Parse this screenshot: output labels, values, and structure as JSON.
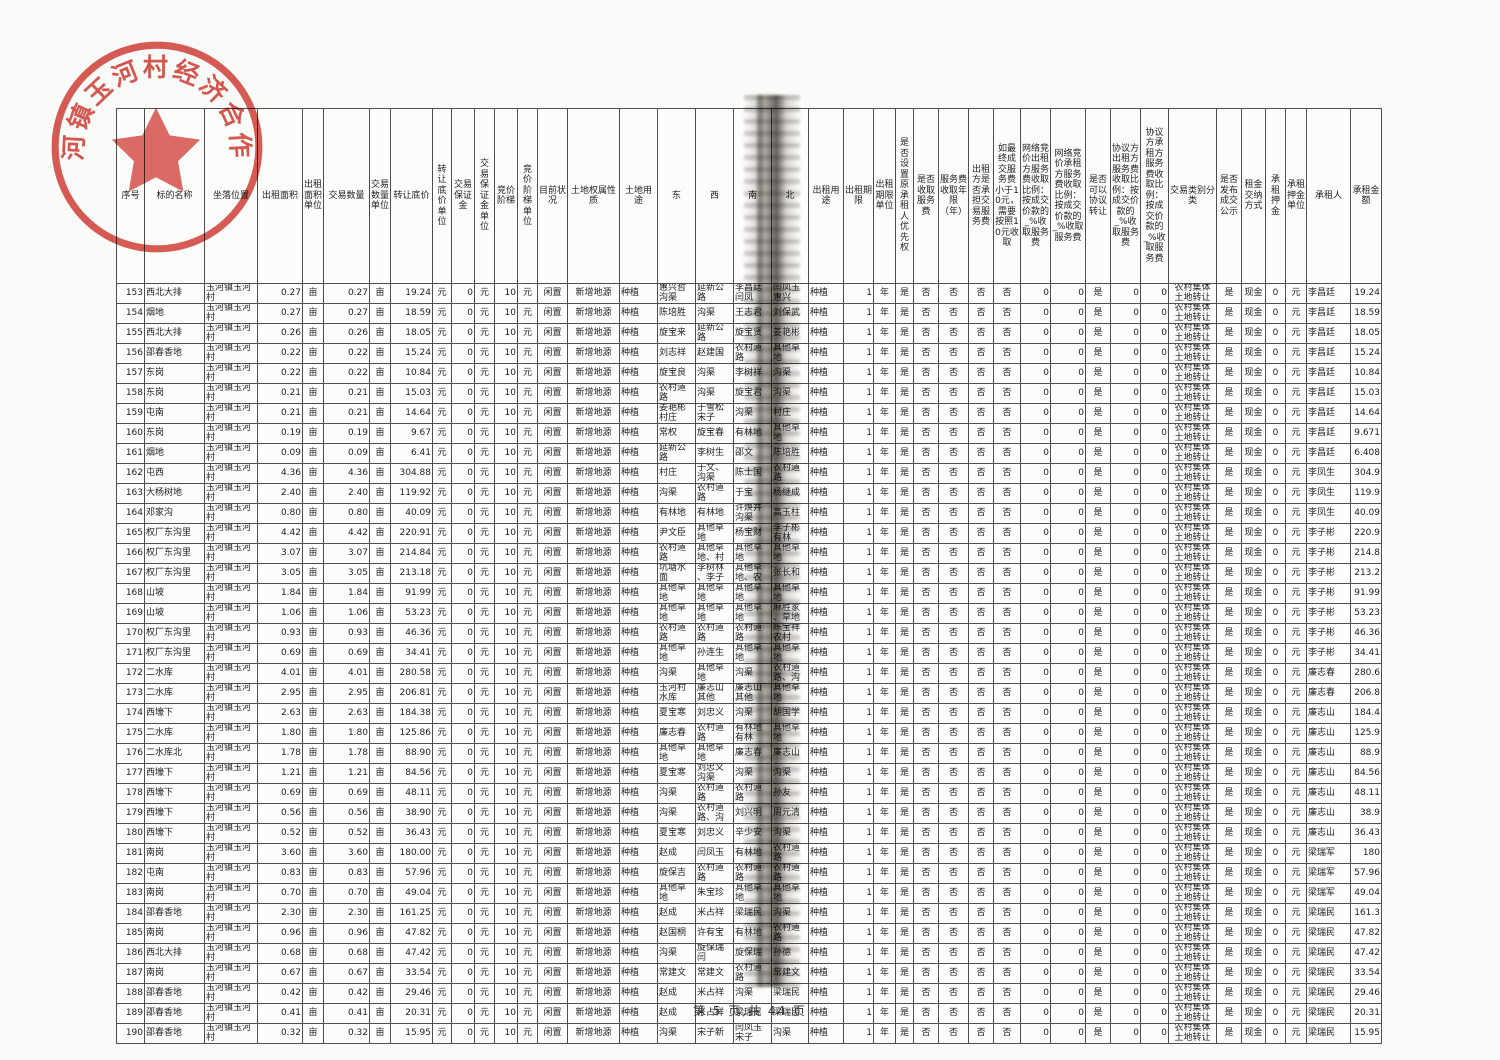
{
  "page": {
    "footer": "第 5 页,共 44 页"
  },
  "stamp": {
    "text": "玉河镇玉河村经济合作社",
    "color": "#cf3128"
  },
  "table": {
    "headers": [
      "序号",
      "标的名称",
      "坐落位置",
      "出租面积",
      "出租面积单位",
      "交易数量",
      "交易数量单位",
      "转让底价",
      "转让底价单位",
      "交易保证金",
      "交易保证金单位",
      "竞价阶梯",
      "竞价阶梯单位",
      "目前状况",
      "土地权属性质",
      "土地用途",
      "东",
      "西",
      "南",
      "北",
      "出租用途",
      "出租期限",
      "出租期限单位",
      "是否设置原承租人优先权",
      "是否收取服务费",
      "服务费收取年限（年）",
      "出租方是否承担交易服务费",
      "如最终成交服务费小于10元，需要按照10元收取",
      "网络竞价出租方服务费收取比例：按成交价款的_%收取服务费",
      "网络竞价承租方服务费收取比例：按成交价款的_%收取服务费",
      "是否可以协议转让",
      "协议方出租方服务费收取比例：按成交价款的_%收取服务费",
      "协议方承租方服务费收取比例：按成交价款的_%收取服务费",
      "交易类别分类",
      "是否发布成交公示",
      "租金交纳方式",
      "承租押金",
      "承租押金单位",
      "承租人",
      "承租金额"
    ],
    "constants": {
      "location": "玉河镇玉河村",
      "area_unit": "亩",
      "qty_unit": "亩",
      "price_unit": "元",
      "deposit": "0",
      "deposit_unit": "元",
      "step": "10",
      "step_unit": "元",
      "status": "闲置",
      "ownership": "新增地源",
      "land_use": "种植",
      "lease_use": "种植",
      "term": "1",
      "term_unit": "年",
      "priority": "是",
      "collect_service_fee": "否",
      "fee_years": "否",
      "lessor_bears_fee": "否",
      "min_fee_rule": "否",
      "net_lessor_pct": "0",
      "net_lessee_pct": "0",
      "negotiable_transfer": "是",
      "agr_lessor_pct": "0",
      "agr_lessee_pct": "0",
      "category": "农村集体\n土地转让",
      "publicity": "是",
      "payment": "现金",
      "rent_deposit": "0",
      "rent_deposit_unit": "元"
    },
    "rows": [
      {
        "no": "153",
        "name": "西北大排",
        "area": "0.27",
        "qty": "0.27",
        "price": "19.24",
        "east": "惠兴哲\n沟渠",
        "west": "延新公\n路",
        "south": "李昌廷\n闫凤",
        "north": "闫凤玉\n惠兴",
        "lessee": "李昌廷",
        "amount": "19.24"
      },
      {
        "no": "154",
        "name": "烟地",
        "area": "0.27",
        "qty": "0.27",
        "price": "18.59",
        "east": "陈培胜",
        "west": "沟渠",
        "south": "王志君",
        "north": "刘保武",
        "lessee": "李昌廷",
        "amount": "18.59"
      },
      {
        "no": "155",
        "name": "西北大排",
        "area": "0.26",
        "qty": "0.26",
        "price": "18.05",
        "east": "旋宝来",
        "west": "延新公\n路",
        "south": "旋宝贤",
        "north": "姜艳彬",
        "lessee": "李昌廷",
        "amount": "18.05"
      },
      {
        "no": "156",
        "name": "邵春香地",
        "area": "0.22",
        "qty": "0.22",
        "price": "15.24",
        "east": "刘志祥",
        "west": "赵建国",
        "south": "农村道\n路",
        "north": "其他草\n地",
        "lessee": "李昌廷",
        "amount": "15.24"
      },
      {
        "no": "157",
        "name": "东岗",
        "area": "0.22",
        "qty": "0.22",
        "price": "10.84",
        "east": "旋宝良",
        "west": "沟渠",
        "south": "李树祥",
        "north": "沟渠",
        "lessee": "李昌廷",
        "amount": "10.84"
      },
      {
        "no": "158",
        "name": "东岗",
        "area": "0.21",
        "qty": "0.21",
        "price": "15.03",
        "east": "农村道\n路",
        "west": "沟渠",
        "south": "旋宝君",
        "north": "沟渠",
        "lessee": "李昌廷",
        "amount": "15.03"
      },
      {
        "no": "159",
        "name": "屯南",
        "area": "0.21",
        "qty": "0.21",
        "price": "14.64",
        "east": "姜艳彬\n村庄",
        "west": "于雪松\n宋子",
        "south": "沟渠",
        "north": "村庄",
        "lessee": "李昌廷",
        "amount": "14.64"
      },
      {
        "no": "160",
        "name": "东岗",
        "area": "0.19",
        "qty": "0.19",
        "price": "9.67",
        "east": "常权",
        "west": "旋宝春",
        "south": "有林地",
        "north": "其他草\n地",
        "lessee": "李昌廷",
        "amount": "9.671"
      },
      {
        "no": "161",
        "name": "烟地",
        "area": "0.09",
        "qty": "0.09",
        "price": "6.41",
        "east": "延新公\n路",
        "west": "李树生",
        "south": "邵文",
        "north": "陈培胜",
        "lessee": "李昌廷",
        "amount": "6.408"
      },
      {
        "no": "162",
        "name": "屯西",
        "area": "4.36",
        "qty": "4.36",
        "price": "304.88",
        "east": "村庄",
        "west": "于文、\n沟渠",
        "south": "陈士国",
        "north": "农村道\n路",
        "lessee": "李凤生",
        "amount": "304.9"
      },
      {
        "no": "163",
        "name": "大杨树地",
        "area": "2.40",
        "qty": "2.40",
        "price": "119.92",
        "east": "沟渠",
        "west": "农村道\n路",
        "south": "于宝",
        "north": "杨继成",
        "lessee": "李凤生",
        "amount": "119.9"
      },
      {
        "no": "164",
        "name": "邓家沟",
        "area": "0.80",
        "qty": "0.80",
        "price": "40.09",
        "east": "有林地",
        "west": "有林地",
        "south": "许焕井\n沟渠",
        "north": "高玉柱",
        "lessee": "李凤生",
        "amount": "40.09"
      },
      {
        "no": "165",
        "name": "权厂东沟里",
        "area": "4.42",
        "qty": "4.42",
        "price": "220.91",
        "east": "尹文臣",
        "west": "其他草\n地",
        "south": "杨宝财",
        "north": "李子彬\n有林",
        "lessee": "李子彬",
        "amount": "220.9"
      },
      {
        "no": "166",
        "name": "权厂东沟里",
        "area": "3.07",
        "qty": "3.07",
        "price": "214.84",
        "east": "农村道\n路",
        "west": "其他草\n地、村",
        "south": "其他草\n地",
        "north": "其他草\n地",
        "lessee": "李子彬",
        "amount": "214.8"
      },
      {
        "no": "167",
        "name": "权厂东沟里",
        "area": "3.05",
        "qty": "3.05",
        "price": "213.18",
        "east": "坑塘水\n面",
        "west": "李树林\n、李子",
        "south": "其他草\n地、农",
        "north": "张长和",
        "lessee": "李子彬",
        "amount": "213.2"
      },
      {
        "no": "168",
        "name": "山坡",
        "area": "1.84",
        "qty": "1.84",
        "price": "91.99",
        "east": "其他草\n地",
        "west": "其他草\n地",
        "south": "其他草\n地",
        "north": "其他草\n地",
        "lessee": "李子彬",
        "amount": "91.99"
      },
      {
        "no": "169",
        "name": "山坡",
        "area": "1.06",
        "qty": "1.06",
        "price": "53.23",
        "east": "其他草\n地",
        "west": "其他草\n地",
        "south": "其他草\n地",
        "north": "麻胜家\n、草地",
        "lessee": "李子彬",
        "amount": "53.23"
      },
      {
        "no": "170",
        "name": "权厂东沟里",
        "area": "0.93",
        "qty": "0.93",
        "price": "46.36",
        "east": "农村道\n路",
        "west": "农村道\n路",
        "south": "农村道\n路",
        "north": "陈宝祥\n农村",
        "lessee": "李子彬",
        "amount": "46.36"
      },
      {
        "no": "171",
        "name": "权厂东沟里",
        "area": "0.69",
        "qty": "0.69",
        "price": "34.41",
        "east": "其他草\n地",
        "west": "孙连生",
        "south": "其他草\n地",
        "north": "其他草\n地",
        "lessee": "李子彬",
        "amount": "34.41"
      },
      {
        "no": "172",
        "name": "二水库",
        "area": "4.01",
        "qty": "4.01",
        "price": "280.58",
        "east": "沟渠",
        "west": "其他草\n地",
        "south": "沟渠",
        "north": "农村道\n路、沟",
        "lessee": "廉志春",
        "amount": "280.6"
      },
      {
        "no": "173",
        "name": "二水库",
        "area": "2.95",
        "qty": "2.95",
        "price": "206.81",
        "east": "玉河村\n水库",
        "west": "廉志山\n其他",
        "south": "廉志山\n其他",
        "north": "其他草\n地",
        "lessee": "廉志春",
        "amount": "206.8"
      },
      {
        "no": "174",
        "name": "西壕下",
        "area": "2.63",
        "qty": "2.63",
        "price": "184.38",
        "east": "夏宝寒",
        "west": "刘忠义",
        "south": "沟渠",
        "north": "胡国学",
        "lessee": "廉志山",
        "amount": "184.4"
      },
      {
        "no": "175",
        "name": "二水库",
        "area": "1.80",
        "qty": "1.80",
        "price": "125.86",
        "east": "廉志春",
        "west": "农村道\n路",
        "south": "有林地\n有林",
        "north": "其他草\n地",
        "lessee": "廉志山",
        "amount": "125.9"
      },
      {
        "no": "176",
        "name": "二水库北",
        "area": "1.78",
        "qty": "1.78",
        "price": "88.90",
        "east": "其他草\n地",
        "west": "其他草\n地",
        "south": "廉志春",
        "north": "廉志山",
        "lessee": "廉志山",
        "amount": "88.9"
      },
      {
        "no": "177",
        "name": "西壕下",
        "area": "1.21",
        "qty": "1.21",
        "price": "84.56",
        "east": "夏宝寒",
        "west": "刘忠义\n沟渠",
        "south": "沟渠",
        "north": "沟渠",
        "lessee": "廉志山",
        "amount": "84.56"
      },
      {
        "no": "178",
        "name": "西壕下",
        "area": "0.69",
        "qty": "0.69",
        "price": "48.11",
        "east": "沟渠",
        "west": "农村道\n路",
        "south": "农村道\n路",
        "north": "孙友",
        "lessee": "廉志山",
        "amount": "48.11"
      },
      {
        "no": "179",
        "name": "西壕下",
        "area": "0.56",
        "qty": "0.56",
        "price": "38.90",
        "east": "沟渠",
        "west": "农村道\n路、沟",
        "south": "刘兴明",
        "north": "周元清",
        "lessee": "廉志山",
        "amount": "38.9"
      },
      {
        "no": "180",
        "name": "西壕下",
        "area": "0.52",
        "qty": "0.52",
        "price": "36.43",
        "east": "夏宝寒",
        "west": "刘忠义",
        "south": "辛少安",
        "north": "沟渠",
        "lessee": "廉志山",
        "amount": "36.43"
      },
      {
        "no": "181",
        "name": "南岗",
        "area": "3.60",
        "qty": "3.60",
        "price": "180.00",
        "east": "赵成",
        "west": "闫凤玉",
        "south": "有林地",
        "north": "农村道\n路",
        "lessee": "梁瑞军",
        "amount": "180"
      },
      {
        "no": "182",
        "name": "屯南",
        "area": "0.83",
        "qty": "0.83",
        "price": "57.96",
        "east": "旋保吉",
        "west": "农村道\n路",
        "south": "农村道\n路",
        "north": "农村道\n路",
        "lessee": "梁瑞军",
        "amount": "57.96"
      },
      {
        "no": "183",
        "name": "南岗",
        "area": "0.70",
        "qty": "0.70",
        "price": "49.04",
        "east": "其他草\n地",
        "west": "朱宝珍",
        "south": "其他草\n地",
        "north": "其他草\n地",
        "lessee": "梁瑞军",
        "amount": "49.04"
      },
      {
        "no": "184",
        "name": "邵春香地",
        "area": "2.30",
        "qty": "2.30",
        "price": "161.25",
        "east": "赵成",
        "west": "米占祥",
        "south": "梁瑞民",
        "north": "沟渠",
        "lessee": "梁瑞民",
        "amount": "161.3"
      },
      {
        "no": "185",
        "name": "南岗",
        "area": "0.96",
        "qty": "0.96",
        "price": "47.82",
        "east": "赵国桐",
        "west": "许有宝",
        "south": "有林地",
        "north": "农村道\n路",
        "lessee": "梁瑞民",
        "amount": "47.82"
      },
      {
        "no": "186",
        "name": "西北大排",
        "area": "0.68",
        "qty": "0.68",
        "price": "47.42",
        "east": "沟渠",
        "west": "旋保瑞\n闫",
        "south": "旋保瑞",
        "north": "孙德",
        "lessee": "梁瑞民",
        "amount": "47.42"
      },
      {
        "no": "187",
        "name": "南岗",
        "area": "0.67",
        "qty": "0.67",
        "price": "33.54",
        "east": "常建文",
        "west": "常建文",
        "south": "农村道\n路",
        "north": "常建文",
        "lessee": "梁瑞民",
        "amount": "33.54"
      },
      {
        "no": "188",
        "name": "邵春香地",
        "area": "0.42",
        "qty": "0.42",
        "price": "29.46",
        "east": "赵成",
        "west": "米占祥",
        "south": "沟渠",
        "north": "梁瑞民",
        "lessee": "梁瑞民",
        "amount": "29.46"
      },
      {
        "no": "189",
        "name": "邵春香地",
        "area": "0.41",
        "qty": "0.41",
        "price": "20.31",
        "east": "赵成",
        "west": "米占祥",
        "south": "梁瑞民",
        "north": "梁瑞民",
        "lessee": "梁瑞民",
        "amount": "20.31"
      },
      {
        "no": "190",
        "name": "邵春香地",
        "area": "0.32",
        "qty": "0.32",
        "price": "15.95",
        "east": "沟渠",
        "west": "宋子新",
        "south": "闫凤玉\n宋子",
        "north": "沟渠",
        "lessee": "梁瑞民",
        "amount": "15.95"
      }
    ]
  }
}
